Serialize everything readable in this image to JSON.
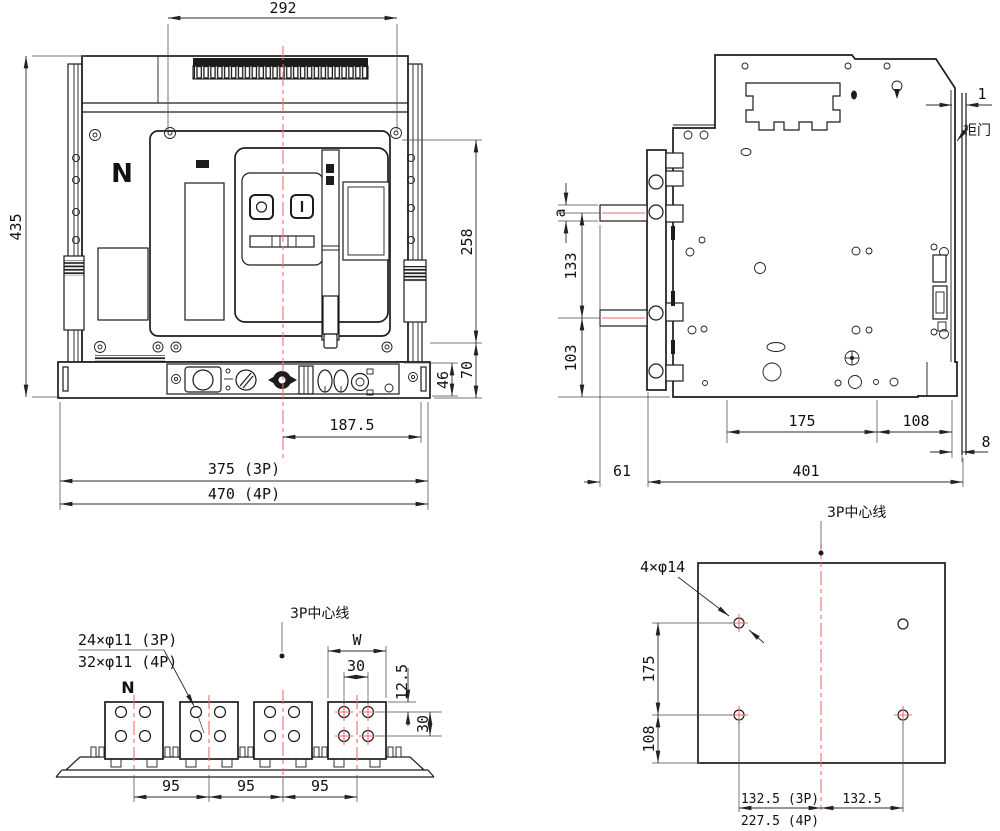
{
  "meta": {
    "drawing_type": "circuit-breaker outline and installation dimension drawing",
    "views": [
      "front view",
      "side view",
      "terminal bottom view",
      "mounting hole plan"
    ]
  },
  "colors": {
    "line": "#1c1c1c",
    "centerline_red": "#ee6b6b",
    "text": "#111111",
    "background": "#ffffff"
  },
  "front_view": {
    "pole_label": "N",
    "dims": {
      "top_width": "292",
      "height": "435",
      "right_height": "258",
      "bottom_right_70": "70",
      "rail_46": "46",
      "center_offset": "187.5",
      "width_3p": "375 (3P)",
      "width_4p": "470 (4P)"
    }
  },
  "side_view": {
    "labels": {
      "door_gap": "1",
      "cabinet_door": "柜门",
      "bar_thickness": "a"
    },
    "dims": {
      "stub_pitch": "133",
      "stub_bottom": "103",
      "depth_175": "175",
      "depth_108": "108",
      "door_depth": "8",
      "stub_len": "61",
      "depth_total": "401"
    }
  },
  "bottom_view": {
    "labels": {
      "neutral": "N",
      "holes_3p": "24×φ11 (3P)",
      "holes_4p": "32×φ11 (4P)",
      "centerline": "3P中心线",
      "terminal_width": "W"
    },
    "dims": {
      "hole_spacing_h": "30",
      "edge_offset": "12.5",
      "hole_spacing_v": "30",
      "pole_pitch": [
        "95",
        "95",
        "95"
      ]
    }
  },
  "mounting_view": {
    "labels": {
      "holes": "4×φ14",
      "centerline": "3P中心线"
    },
    "dims": {
      "hole_pitch_v": "175",
      "hole_to_edge": "108",
      "bottom_left_3p": "132.5 (3P)",
      "bottom_right": "132.5",
      "bottom_left_4p": "227.5 (4P)"
    }
  }
}
